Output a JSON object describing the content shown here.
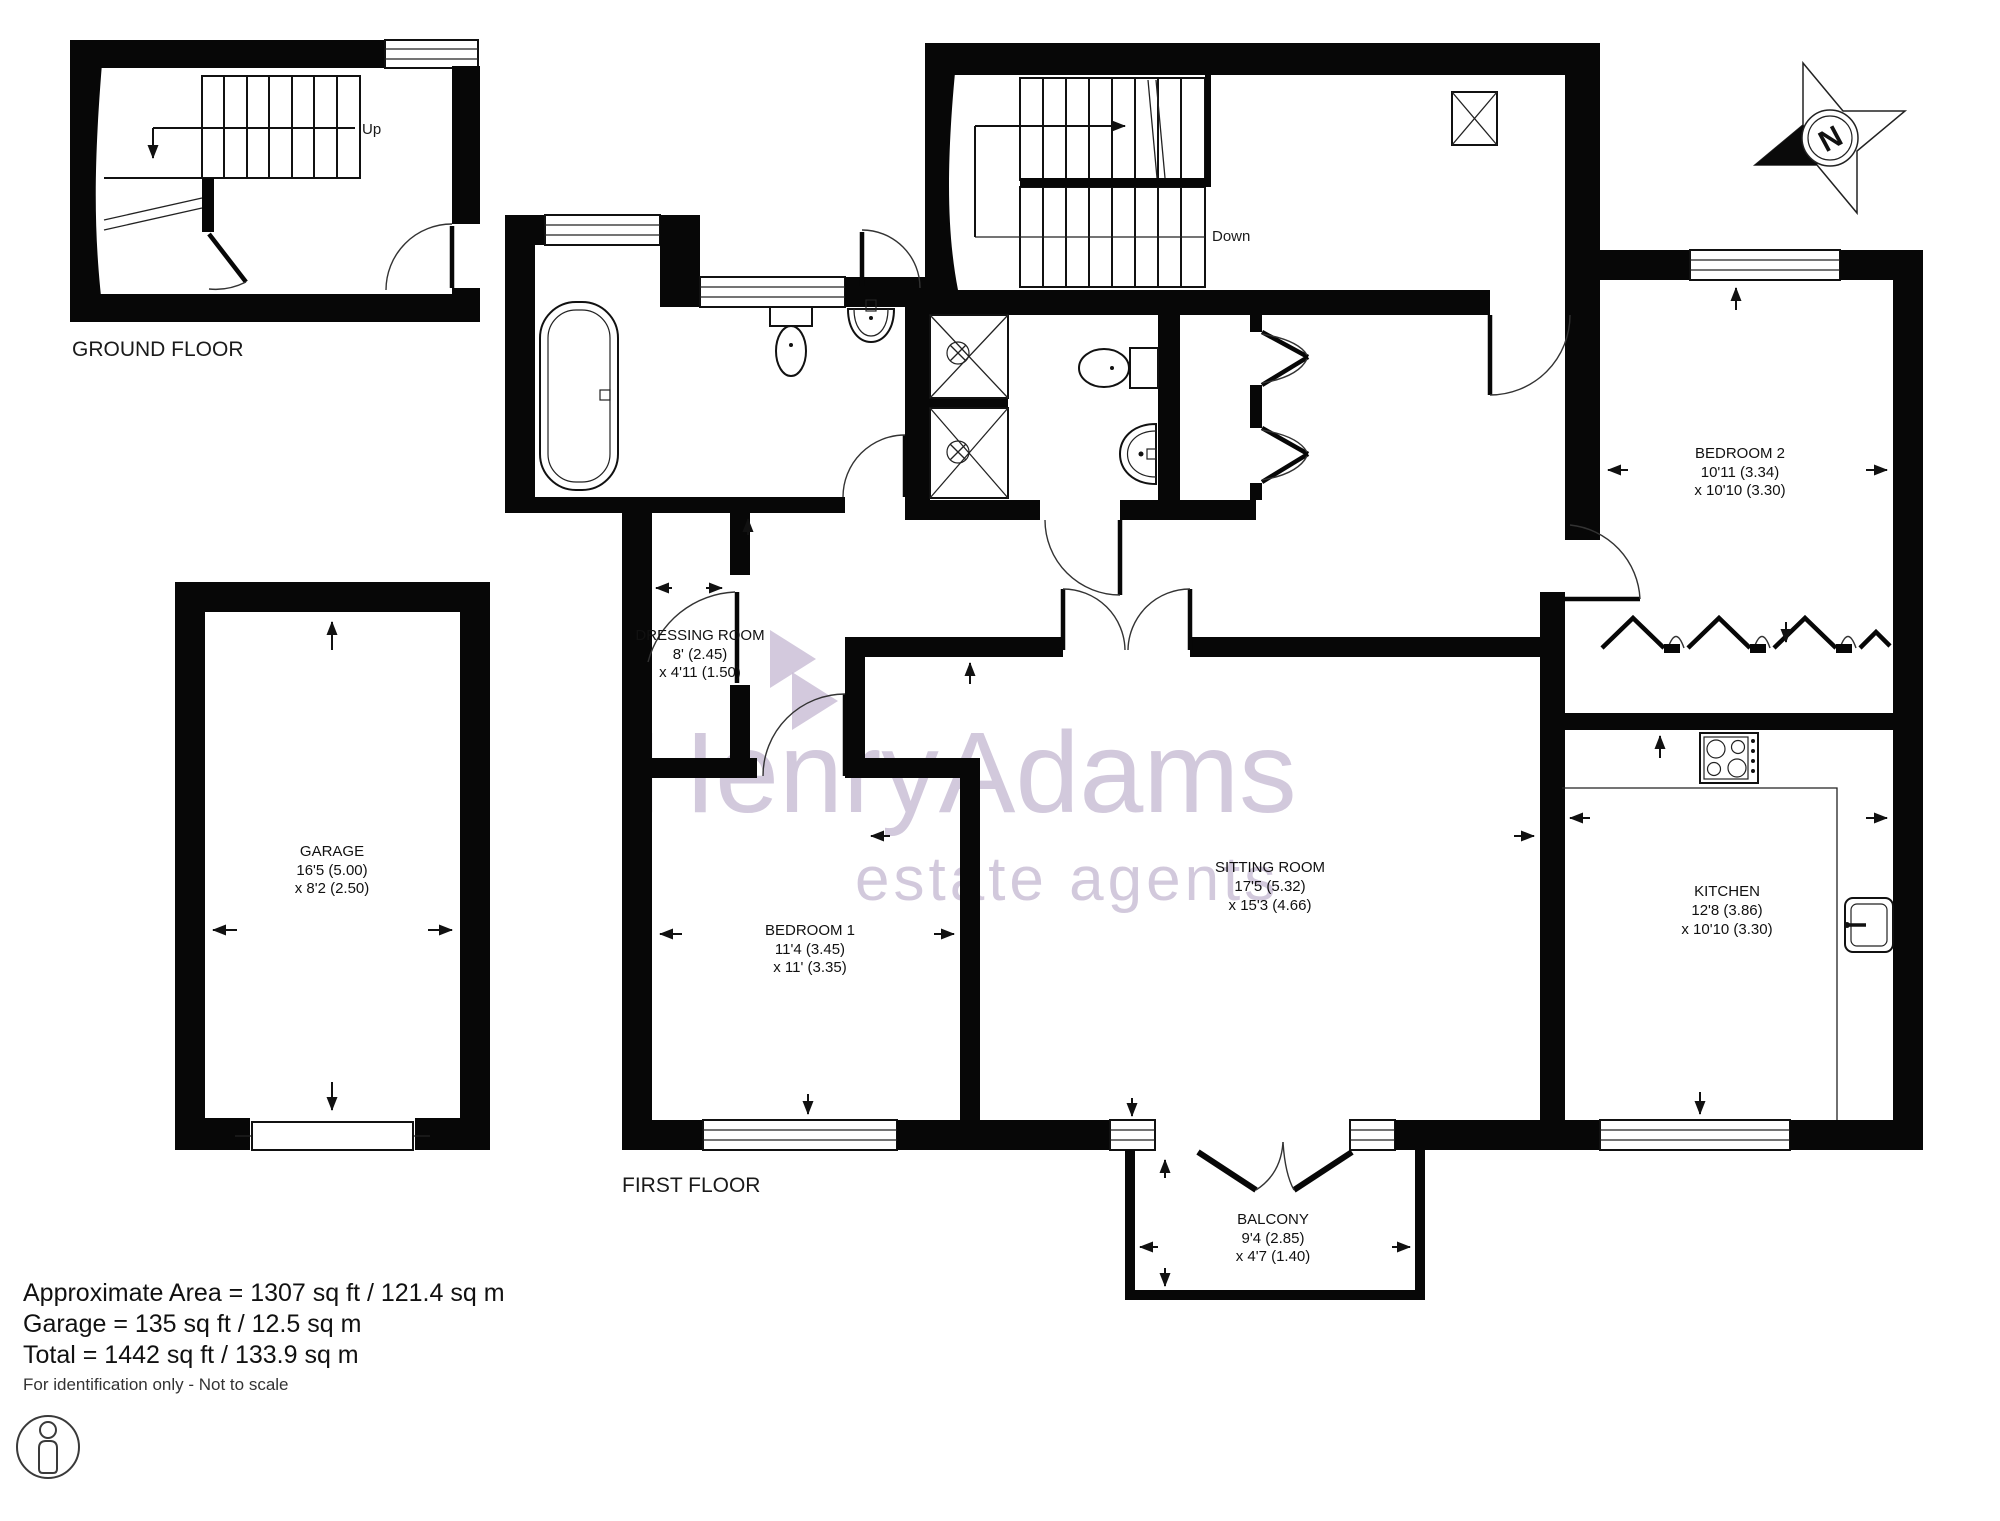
{
  "plans": {
    "ground_floor": {
      "title": "GROUND FLOOR",
      "stairs_label": "Up"
    },
    "first_floor": {
      "title": "FIRST FLOOR",
      "stairs_label": "Down"
    }
  },
  "rooms": {
    "garage": {
      "name": "GARAGE",
      "dim1": "16'5 (5.00)",
      "dim2": "x 8'2 (2.50)"
    },
    "dressing_room": {
      "name": "DRESSING ROOM",
      "dim1": "8' (2.45)",
      "dim2": "x 4'11 (1.50)"
    },
    "bedroom_1": {
      "name": "BEDROOM 1",
      "dim1": "11'4 (3.45)",
      "dim2": "x 11' (3.35)"
    },
    "bedroom_2": {
      "name": "BEDROOM 2",
      "dim1": "10'11 (3.34)",
      "dim2": "x 10'10 (3.30)"
    },
    "sitting_room": {
      "name": "SITTING ROOM",
      "dim1": "17'5 (5.32)",
      "dim2": "x 15'3 (4.66)"
    },
    "kitchen": {
      "name": "KITCHEN",
      "dim1": "12'8 (3.86)",
      "dim2": "x 10'10 (3.30)"
    },
    "balcony": {
      "name": "BALCONY",
      "dim1": "9'4 (2.85)",
      "dim2": "x 4'7 (1.40)"
    }
  },
  "summary": {
    "lines": [
      "Approximate Area = 1307 sq ft / 121.4 sq m",
      "Garage = 135 sq ft / 12.5 sq m",
      "Total = 1442 sq ft / 133.9 sq m"
    ],
    "disclaimer": "For identification only - Not to scale"
  },
  "watermark": {
    "name": "HenryAdams",
    "tagline": "estate agents"
  },
  "compass": {
    "north_label": "N"
  },
  "colors": {
    "wall": "#070707",
    "watermark": "#c8bcd4"
  }
}
